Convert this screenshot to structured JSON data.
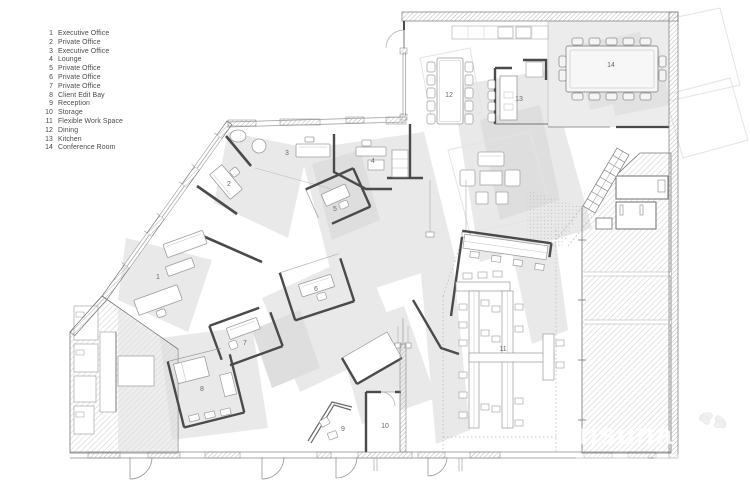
{
  "legend": {
    "items": [
      {
        "num": "1",
        "label": "Executive Office"
      },
      {
        "num": "2",
        "label": "Private Office"
      },
      {
        "num": "3",
        "label": "Executive Office"
      },
      {
        "num": "4",
        "label": "Lounge"
      },
      {
        "num": "5",
        "label": "Private Office"
      },
      {
        "num": "6",
        "label": "Private Office"
      },
      {
        "num": "7",
        "label": "Private Office"
      },
      {
        "num": "8",
        "label": "Client Edit Bay"
      },
      {
        "num": "9",
        "label": "Reception"
      },
      {
        "num": "10",
        "label": "Storage"
      },
      {
        "num": "11",
        "label": "Flexible Work Space"
      },
      {
        "num": "12",
        "label": "Dining"
      },
      {
        "num": "13",
        "label": "Kitchen"
      },
      {
        "num": "14",
        "label": "Conference Room"
      }
    ]
  },
  "plan": {
    "room_numbers": [
      "1",
      "2",
      "3",
      "4",
      "5",
      "6",
      "7",
      "8",
      "9",
      "10",
      "11",
      "12",
      "13",
      "14"
    ]
  },
  "watermark": {
    "brand": "ansuna"
  },
  "colors": {
    "wall": "#4a4a4a",
    "wall_light": "#999999",
    "hatch": "#c6c6c6",
    "shadow": "#e9e9e9",
    "room_fill": "#ececec",
    "number": "#6b6b6b",
    "legend_text": "#4a4a4a",
    "watermark": "#ffffff"
  }
}
